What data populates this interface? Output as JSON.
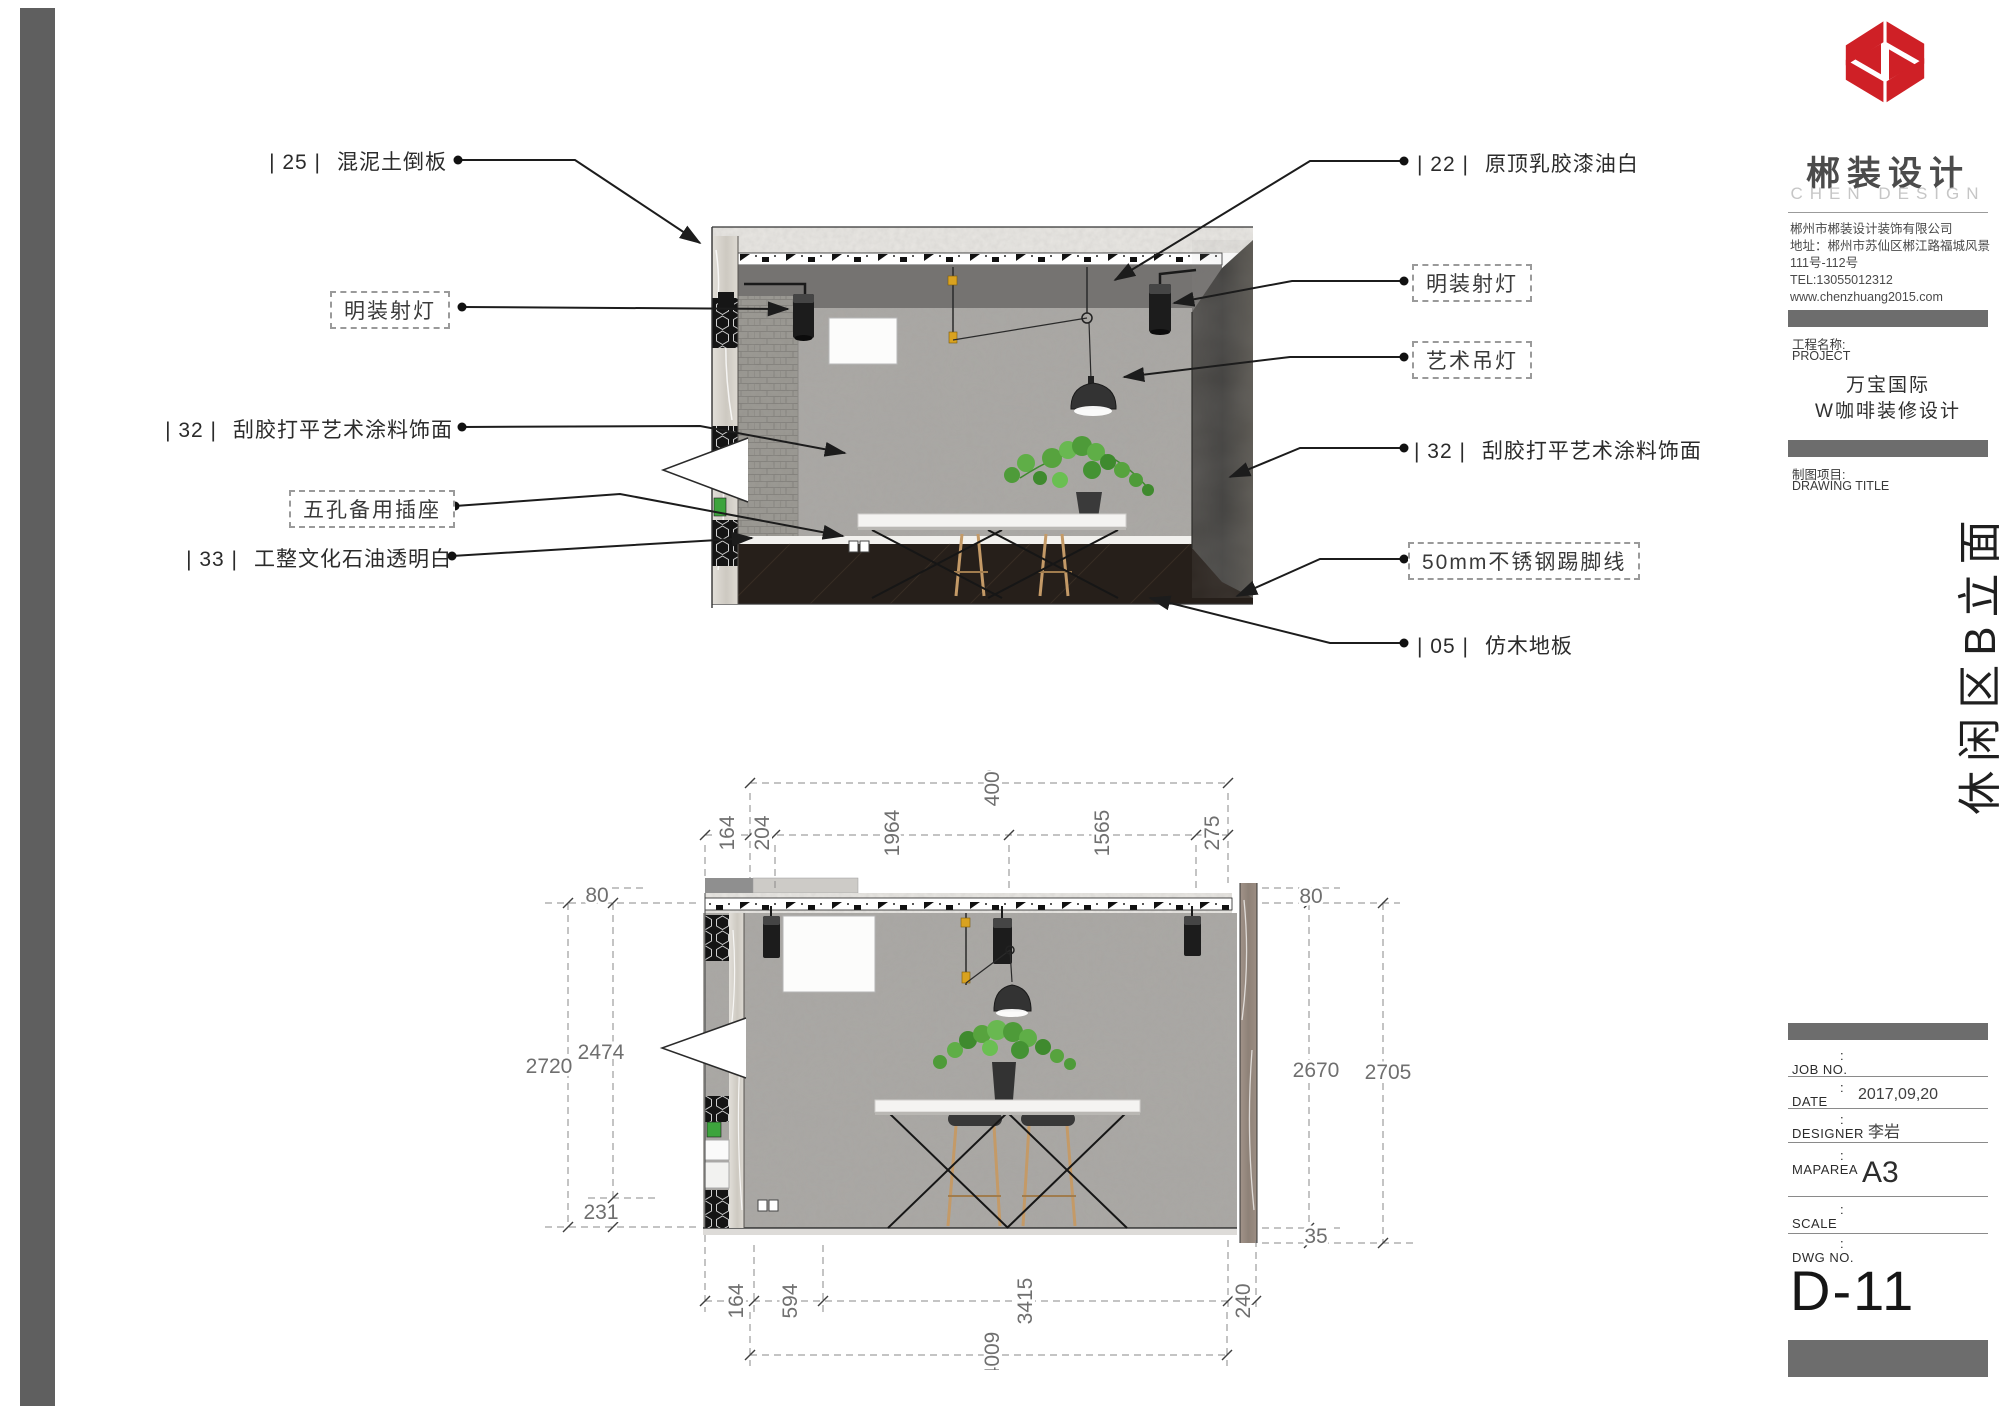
{
  "title_block": {
    "brand": {
      "name": "郴装设计",
      "subtitle": "CHEN DESIGN",
      "logo_color": "#cf2026"
    },
    "company": {
      "lines": [
        "郴州市郴装设计装饰有限公司",
        "地址：郴州市苏仙区郴江路福城风景",
        "111号-112号",
        "TEL:13055012312",
        "www.chenzhuang2015.com"
      ]
    },
    "project": {
      "label_cn": "工程名称:",
      "label_en": "PROJECT",
      "name_line1": "万宝国际",
      "name_line2": "W咖啡装修设计"
    },
    "drawing_section": {
      "label_cn": "制图项目:",
      "label_en": "DRAWING TITLE"
    },
    "vertical_title": "休闲区B立面",
    "colon": ":",
    "job_table": {
      "rows": [
        {
          "label": "JOB NO.",
          "value": ""
        },
        {
          "label": "DATE",
          "value": "2017,09,20"
        },
        {
          "label": "DESIGNER",
          "value": "李岩"
        },
        {
          "label": "MAPAREA",
          "value": "A3"
        },
        {
          "label": "SCALE",
          "value": ""
        },
        {
          "label": "DWG NO.",
          "value": ""
        }
      ]
    },
    "dwg_no": "D-11"
  },
  "callouts": {
    "left": [
      {
        "code": "| 25 |",
        "text": "混泥土倒板"
      },
      {
        "text": "明装射灯"
      },
      {
        "code": "| 32 |",
        "text": "刮胶打平艺术涂料饰面"
      },
      {
        "text": "五孔备用插座"
      },
      {
        "code": "| 33 |",
        "text": "工整文化石油透明白"
      }
    ],
    "right": [
      {
        "code": "| 22 |",
        "text": "原顶乳胶漆油白"
      },
      {
        "text": "明装射灯"
      },
      {
        "text": "艺术吊灯"
      },
      {
        "code": "| 32 |",
        "text": "刮胶打平艺术涂料饰面"
      },
      {
        "text": "50mm不锈钢踢脚线"
      },
      {
        "code": "| 05 |",
        "text": "仿木地板"
      }
    ]
  },
  "dims": {
    "top_overall": "4009",
    "top_segments": [
      "164",
      "204",
      "1964",
      "1565",
      "275"
    ],
    "left": {
      "t80": "80",
      "outer": "2720",
      "inner": "2474",
      "bottom": "231"
    },
    "right": {
      "t80": "80",
      "inner": "2670",
      "outer": "2705",
      "bottom": "35"
    },
    "bottom_segments": [
      "164",
      "594",
      "3415",
      "240"
    ],
    "bottom_overall": "4009"
  }
}
